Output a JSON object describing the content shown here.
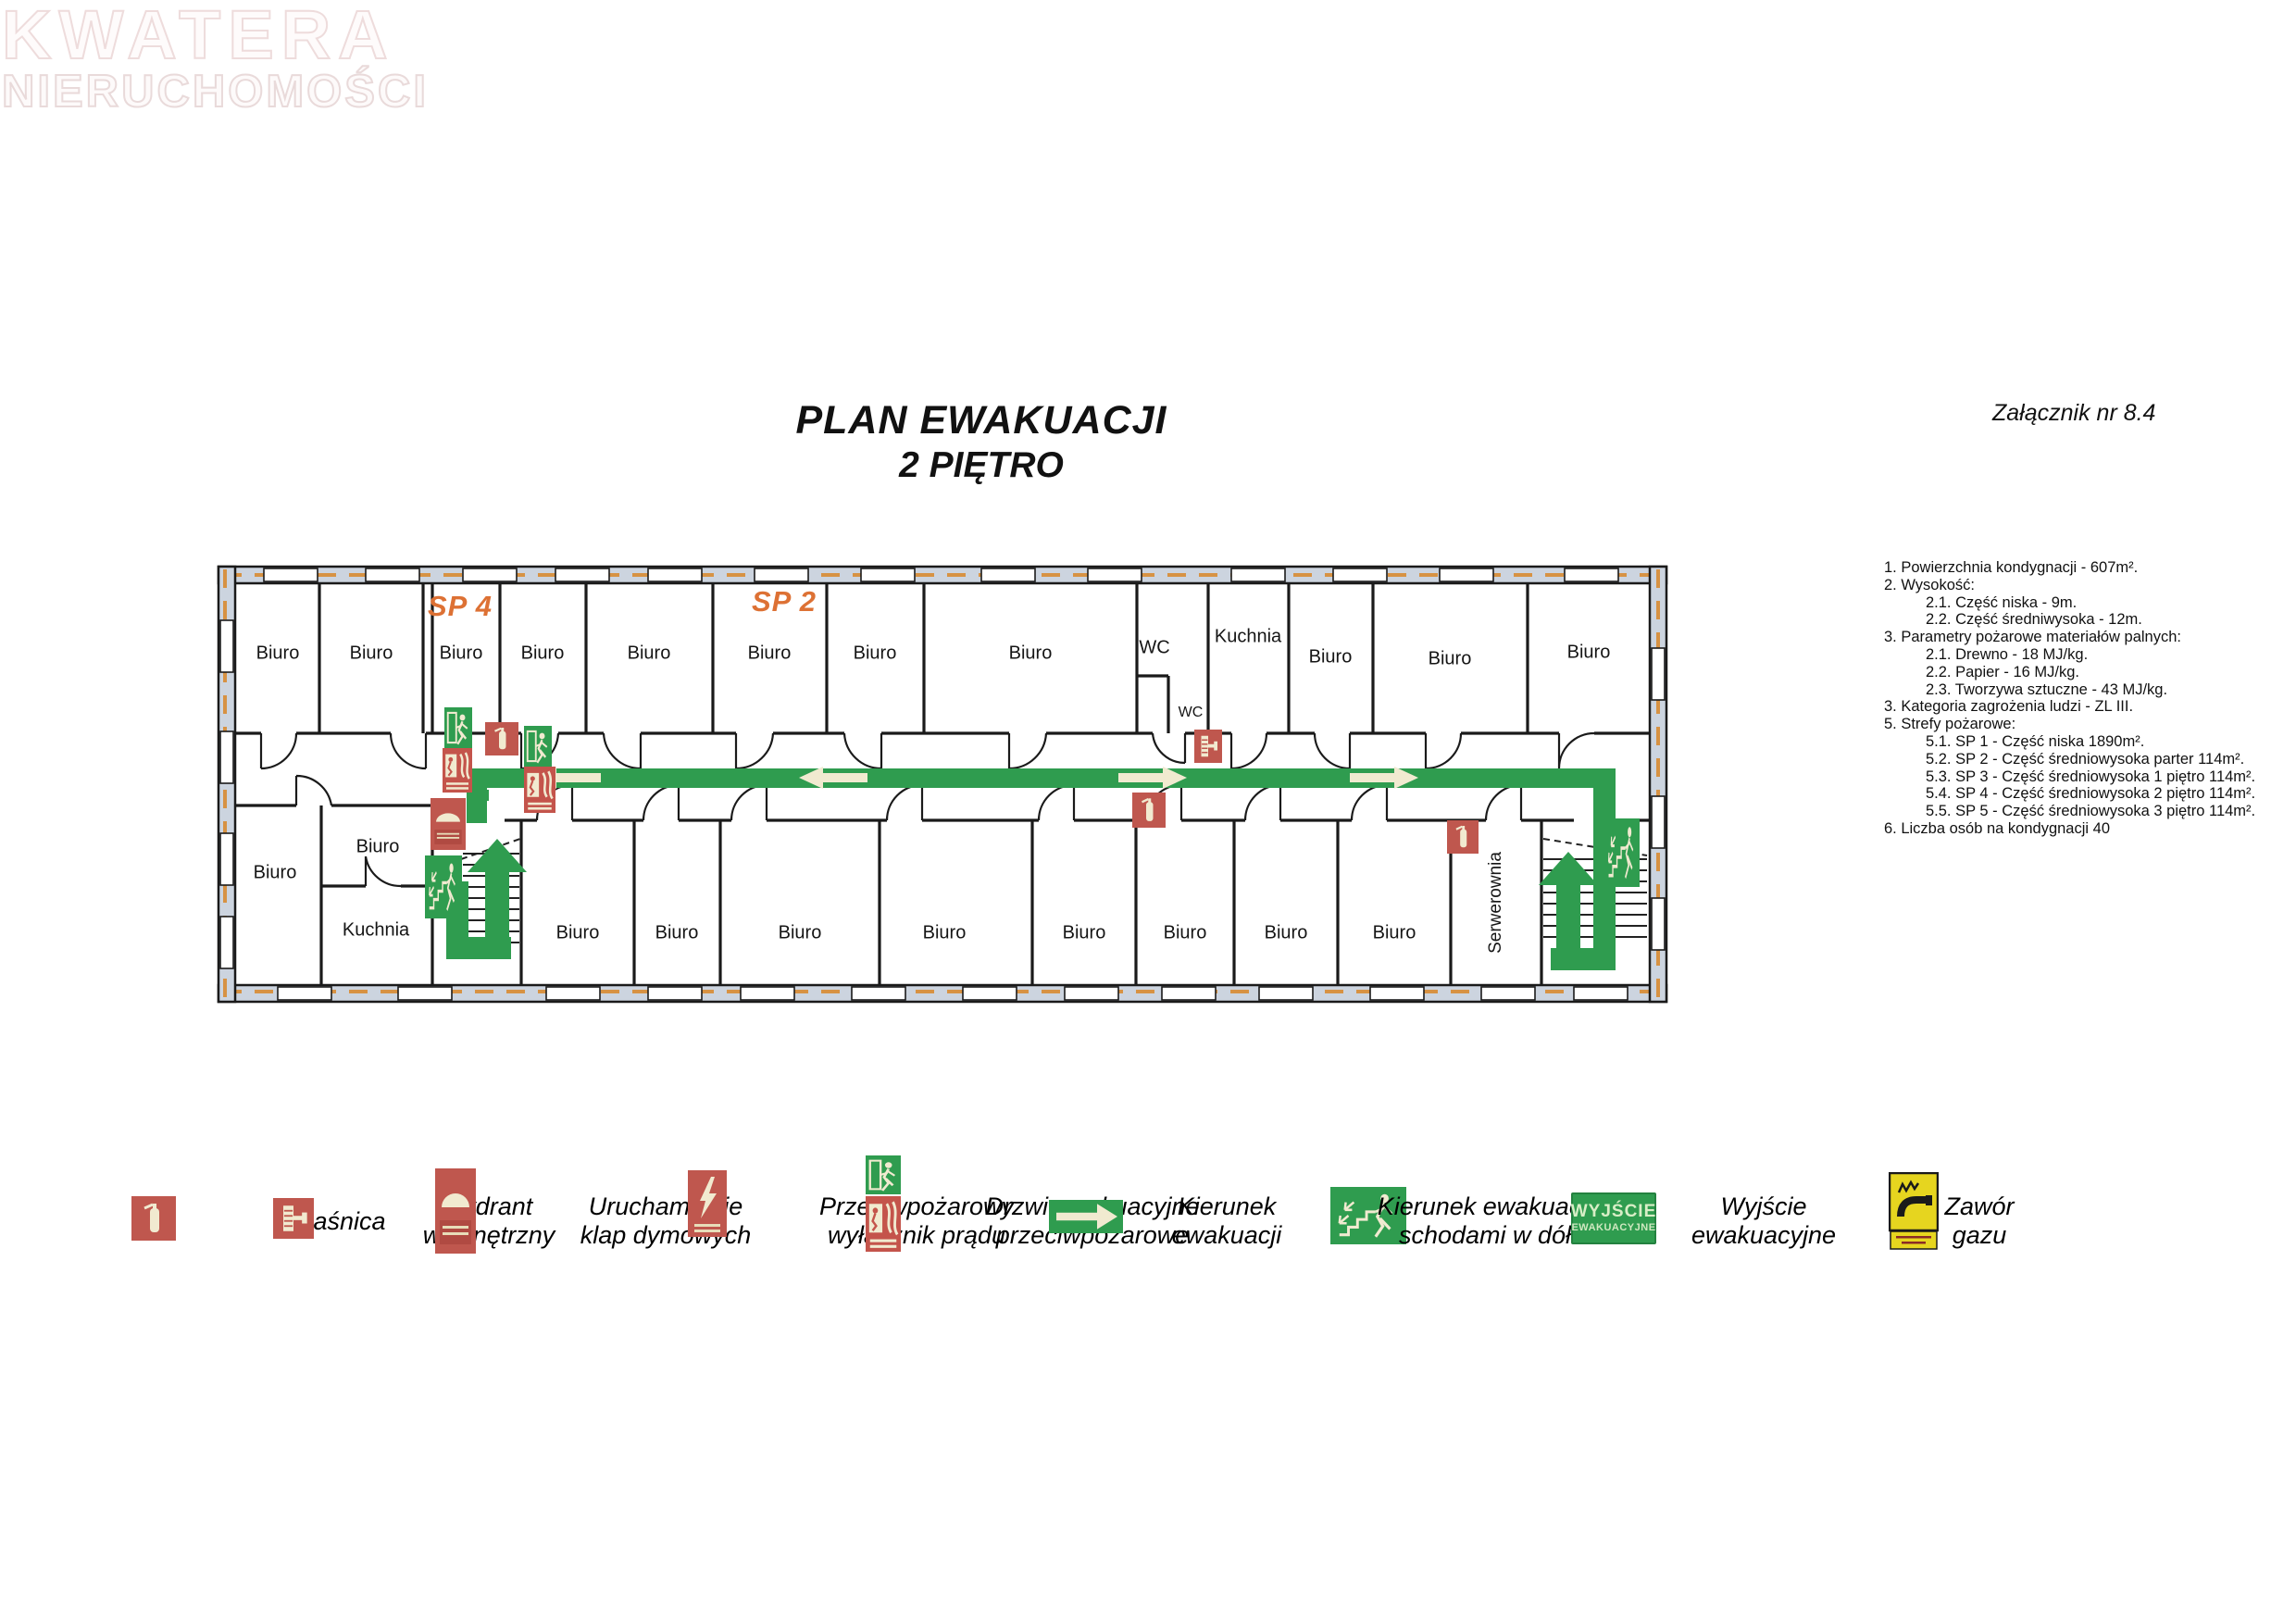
{
  "watermark": {
    "line1": "KWATERA",
    "line2": "NIERUCHOMOŚCI"
  },
  "title": {
    "line1": "PLAN EWAKUACJI",
    "line2": "2 PIĘTRO"
  },
  "attachment_label": "Załącznik nr 8.4",
  "notes": [
    {
      "text": "1. Powierzchnia kondygnacji - 607m²."
    },
    {
      "text": "2. Wysokość:"
    },
    {
      "text": "2.1. Część niska - 9m."
    },
    {
      "text": "2.2. Część średniwysoka - 12m."
    },
    {
      "text": "3. Parametry pożarowe materiałów palnych:"
    },
    {
      "text": "2.1. Drewno - 18 MJ/kg."
    },
    {
      "text": "2.2. Papier - 16 MJ/kg."
    },
    {
      "text": "2.3. Tworzywa sztuczne - 43 MJ/kg."
    },
    {
      "text": "3. Kategoria zagrożenia ludzi - ZL III."
    },
    {
      "text": "5. Strefy pożarowe:"
    },
    {
      "text": "5.1. SP 1 - Część niska 1890m²."
    },
    {
      "text": "5.2. SP 2 - Część średniowysoka parter 114m²."
    },
    {
      "text": "5.3. SP 3 - Część średniowysoka 1 piętro 114m²."
    },
    {
      "text": "5.4. SP 4 - Część średniowysoka 2 piętro 114m²."
    },
    {
      "text": "5.5. SP 5 - Część średniowysoka 3 piętro 114m²."
    },
    {
      "text": "6. Liczba osób na kondygnacji 40"
    }
  ],
  "zones": {
    "sp4": "SP 4",
    "sp2": "SP 2"
  },
  "rooms": [
    "Biuro",
    "Biuro",
    "Biuro",
    "Biuro",
    "Biuro",
    "Biuro",
    "Biuro",
    "Biuro",
    "WC",
    "WC",
    "Kuchnia",
    "Biuro",
    "Biuro",
    "Biuro",
    "Biuro",
    "Biuro",
    "Biuro",
    "Biuro",
    "Biuro",
    "Biuro",
    "Biuro",
    "Biuro",
    "Serwerownia",
    "Biuro",
    "Biuro",
    "Kuchnia"
  ],
  "legend": {
    "items": [
      {
        "icon": "fire-extinguisher-sign",
        "label1": "Gaśnica",
        "label2": ""
      },
      {
        "icon": "internal-hydrant-sign",
        "label1": "Hydrant",
        "label2": "wewnętrzny"
      },
      {
        "icon": "smoke-flap-sign",
        "label1": "Uruchamianie",
        "label2": "klap dymowych"
      },
      {
        "icon": "fire-power-switch-sign",
        "label1": "Przeciwpożarowy",
        "label2": "wyłącznik prądu"
      },
      {
        "icon": "fire-evac-door-sign",
        "label1": "Drzwi ewakuacyjne",
        "label2": "przeciwpożarowe"
      },
      {
        "icon": "evac-direction-arrow-sign",
        "label1": "Kierunek",
        "label2": "ewakuacji"
      },
      {
        "icon": "evac-stairs-down-sign",
        "label1": "Kierunek ewakuacji",
        "label2": "schodami w dół"
      },
      {
        "icon": "evac-exit-text-sign",
        "label1": "Wyjście",
        "label2": "ewakuacyjne"
      },
      {
        "icon": "gas-valve-sign",
        "label1": "Zawór",
        "label2": "gazu"
      }
    ],
    "exit_sign_text": {
      "line1": "WYJŚCIE",
      "line2": "EWAKUACYJNE"
    }
  },
  "colors": {
    "sign_red": "#bf574e",
    "sign_green": "#2f9c4f",
    "sign_cream": "#f1ead0",
    "zone_orange": "#dd7134",
    "wall_fill": "#ccd4df",
    "wall_dash": "#d79243",
    "gas_yellow": "#e6d51f"
  }
}
